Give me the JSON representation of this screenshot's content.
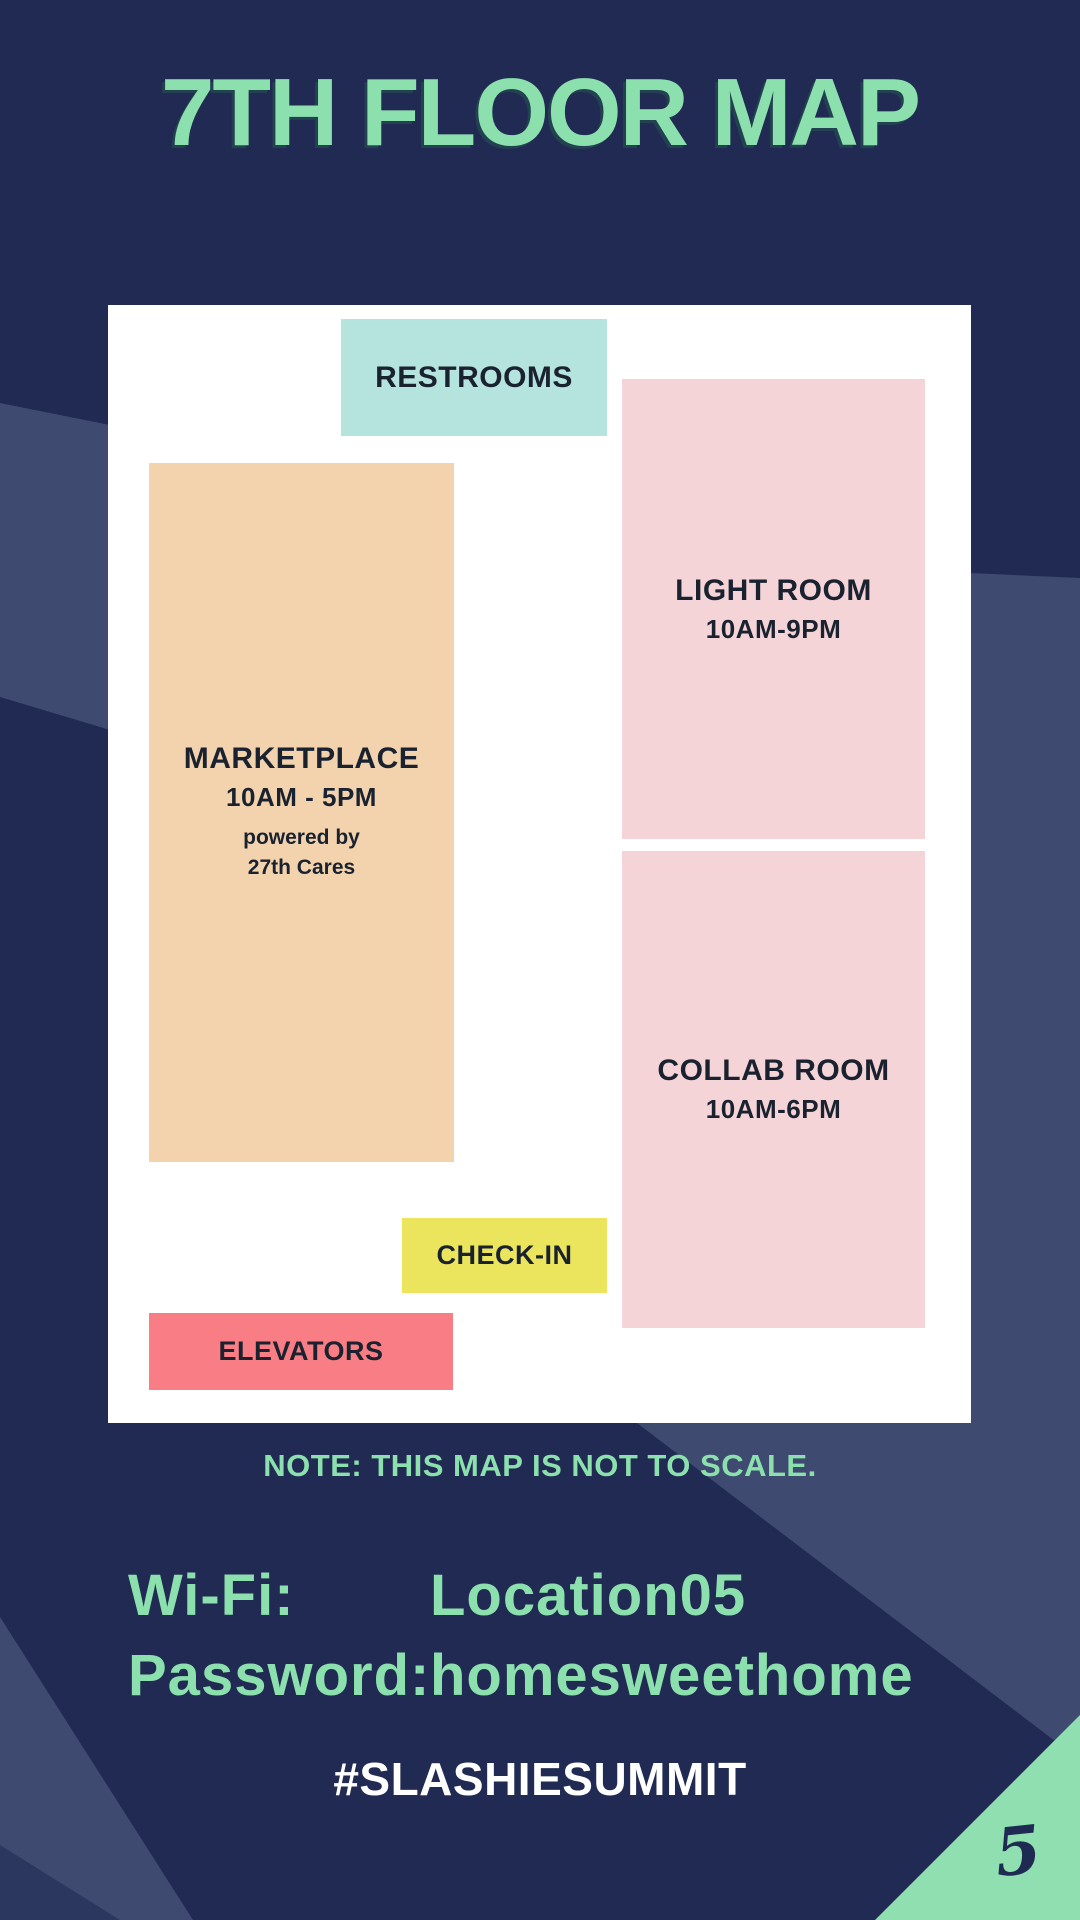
{
  "title": "7TH FLOOR MAP",
  "map": {
    "rooms": [
      {
        "id": "restrooms",
        "label": "RESTROOMS",
        "color": "#b5e3de"
      },
      {
        "id": "light-room",
        "label": "LIGHT ROOM",
        "hours": "10AM-9PM",
        "color": "#f5d4d8"
      },
      {
        "id": "marketplace",
        "label": "MARKETPLACE",
        "hours": "10AM - 5PM",
        "sponsor_line1": "powered by",
        "sponsor_line2": "27th Cares",
        "color": "#f2d3ad"
      },
      {
        "id": "collab-room",
        "label": "COLLAB ROOM",
        "hours": "10AM-6PM",
        "color": "#f5d4d8"
      },
      {
        "id": "check-in",
        "label": "CHECK-IN",
        "color": "#ebe55d"
      },
      {
        "id": "elevators",
        "label": "ELEVATORS",
        "color": "#f97d84"
      }
    ]
  },
  "note": "NOTE: THIS MAP IS NOT TO SCALE.",
  "wifi": {
    "network_label": "Wi-Fi:",
    "network_value": "Location05",
    "password_label": "Password:",
    "password_value": "homesweethome"
  },
  "hashtag": "#SLASHIESUMMIT",
  "page_number": "5",
  "colors": {
    "background": "#202a52",
    "background_light": "#3e4a70",
    "background_corner": "#2c3760",
    "map_background": "#ffffff",
    "accent_mint": "#8ce0ae",
    "corner_triangle": "#90dfb1",
    "room_text": "#1a2230",
    "hashtag_text": "#ffffff"
  }
}
